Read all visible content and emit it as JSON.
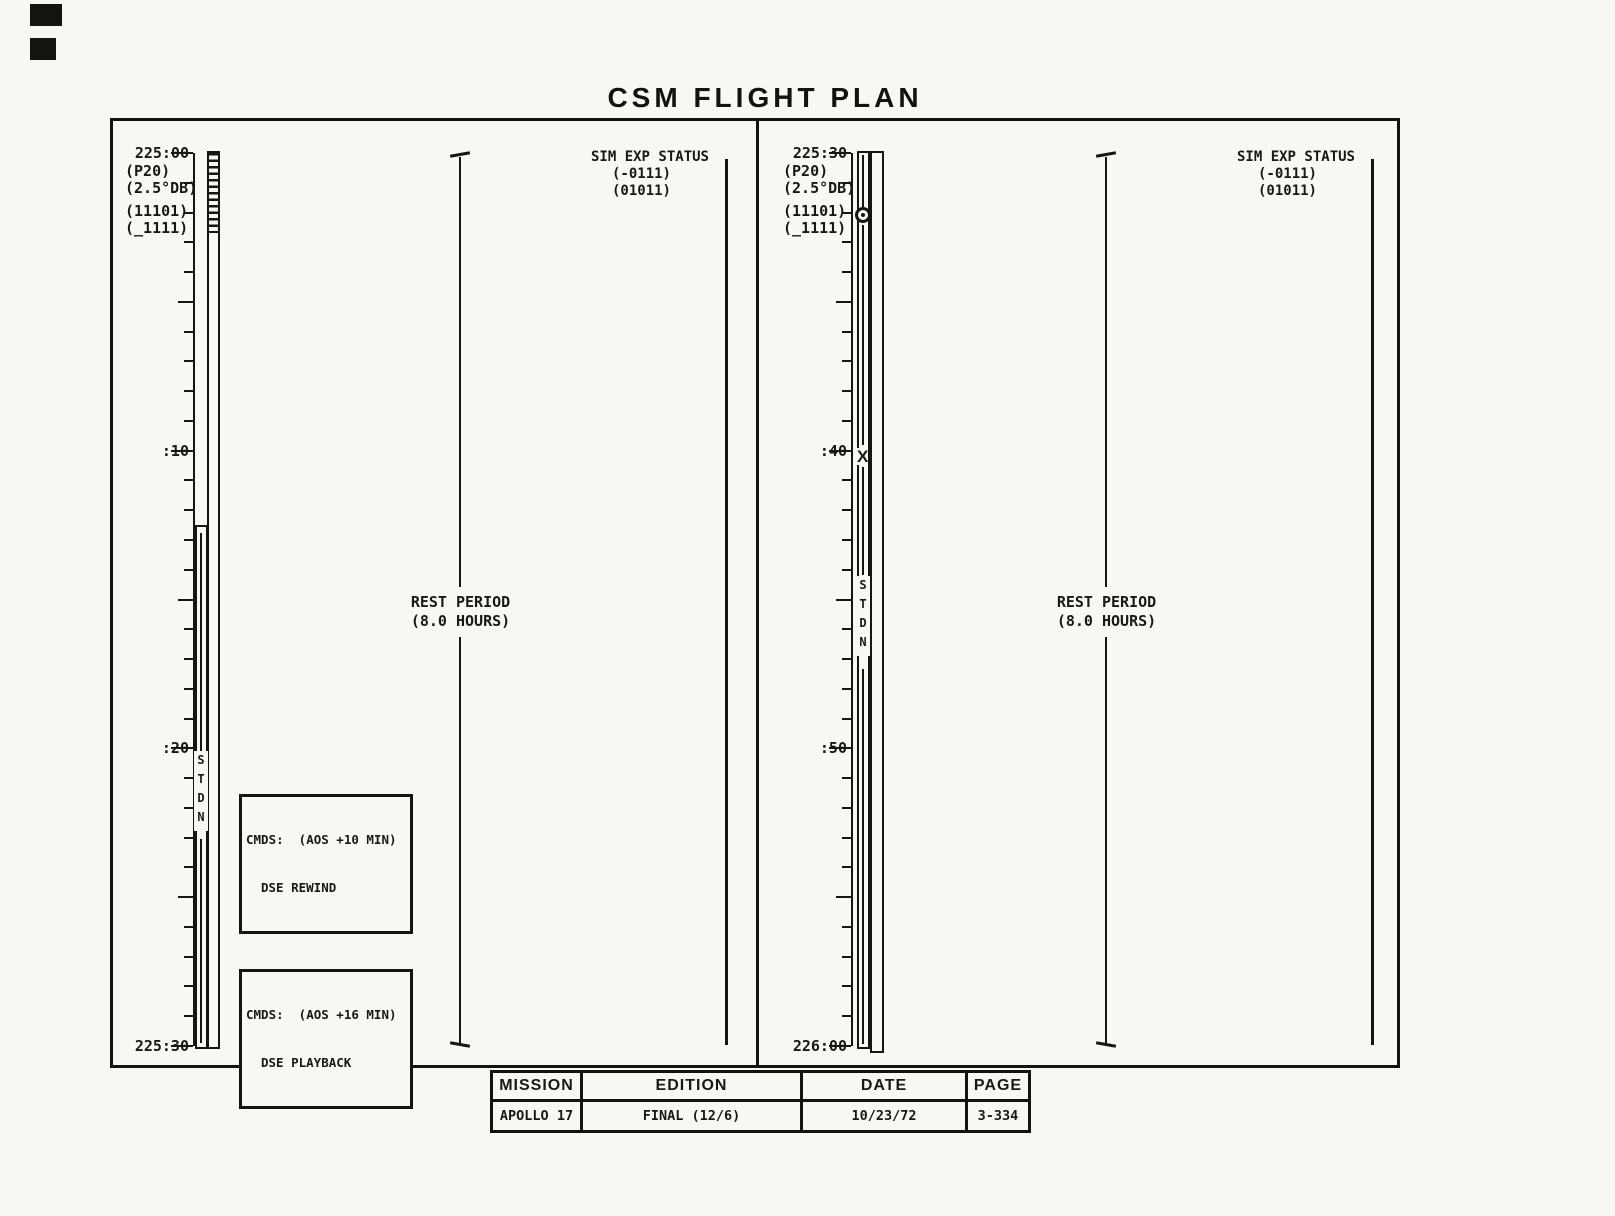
{
  "title": "CSM FLIGHT PLAN",
  "panels": [
    {
      "start_time": "225:00",
      "mid_label_1": ":10",
      "mid_label_2": ":20",
      "end_time": "225:30",
      "mode_annotations": [
        "(P20)",
        "(2.5°DB)"
      ],
      "status_annotations": [
        "(11101)",
        "(_1111)"
      ],
      "sim_exp_status": {
        "title": "SIM EXP STATUS",
        "value1": "(-0111)",
        "value2": "(01011)"
      },
      "rest_period": {
        "title": "REST PERIOD",
        "duration": "(8.0 HOURS)"
      },
      "stdn_label": "STDN",
      "cmd_boxes": [
        {
          "line1": "CMDS:  (AOS +10 MIN)",
          "line2": "DSE REWIND"
        },
        {
          "line1": "CMDS:  (AOS +16 MIN)",
          "line2": "DSE PLAYBACK"
        }
      ]
    },
    {
      "start_time": "225:30",
      "mid_label_1": ":40",
      "mid_label_2": ":50",
      "end_time": "226:00",
      "mode_annotations": [
        "(P20)",
        "(2.5°DB)"
      ],
      "status_annotations": [
        "(11101)",
        "(_1111)"
      ],
      "sim_exp_status": {
        "title": "SIM EXP STATUS",
        "value1": "(-0111)",
        "value2": "(01011)"
      },
      "rest_period": {
        "title": "REST PERIOD",
        "duration": "(8.0 HOURS)"
      },
      "stdn_label": "STDN",
      "x_marker": "X"
    }
  ],
  "footer_table": {
    "headers": [
      "MISSION",
      "EDITION",
      "DATE",
      "PAGE"
    ],
    "values": [
      "APOLLO 17",
      "FINAL (12/6)",
      "10/23/72",
      "3-334"
    ]
  }
}
